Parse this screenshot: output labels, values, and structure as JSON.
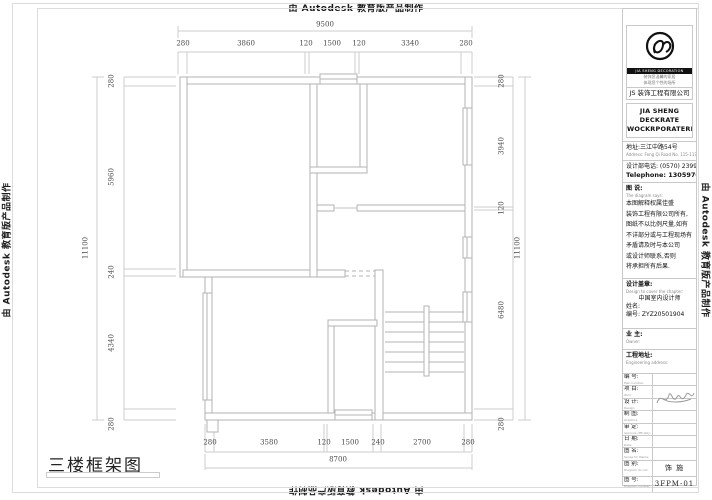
{
  "edge_watermark": "由 Autodesk 教育版产品制作",
  "drawing_title": "三楼框架图",
  "dims": {
    "top": {
      "overall": "9500",
      "segments": [
        "280",
        "3860",
        "120",
        "1500",
        "120",
        "3340",
        "280"
      ]
    },
    "bottom": {
      "overall": "8700",
      "segments": [
        "280",
        "3580",
        "120",
        "1500",
        "240",
        "2700",
        "280"
      ]
    },
    "left": {
      "overall": "11100",
      "segments": [
        "280",
        "5960",
        "240",
        "4340",
        "280"
      ]
    },
    "right": {
      "overall": "11100",
      "segments": [
        "280",
        "3940",
        "120",
        "6480",
        "280"
      ]
    }
  },
  "titleblock": {
    "logo": {
      "brand_en": "JIA SHENG DECORATION",
      "tagline1": "装饰您温馨的家居",
      "tagline2": "体现您个性的场所",
      "company_cn": "JS 装饰工程有限公司",
      "company_en1": "JIA SHENG DECKRATE",
      "company_en2": "WOCKRPORATERKS"
    },
    "address_cn": "地址:三江中路54号",
    "address_en": "Address: Feng Qi Road No. 115-117",
    "phone_cn": "设计部电话: (0570) 2399049",
    "phone_en": "Telephone: 13059700047",
    "notes_title_cn": "图 说:",
    "notes_title_en": "The diagram says:",
    "notes_lines": {
      "0": "本图解释权属佳盛",
      "1": "装饰工程有限公司所有,",
      "2": "图纸不以比例尺量,如有",
      "3": "不详部分或与工程现场有",
      "4": "矛盾请及时与本公司",
      "5": "或设计师联系,否则",
      "6": "将承担所有后果."
    },
    "seal_label_cn": "设计盖章:",
    "seal_label_en": "Design to cover the chapter:",
    "seal_line1": "中国室内设计师",
    "seal_name": "姓名:",
    "seal_no": "编号: ZYZ20501904",
    "owner_cn": "业 主:",
    "owner_en": "Owner:",
    "site_cn": "工程地址:",
    "site_en": "Engineering address:",
    "rows": {
      "0": {
        "cn": "编 号:",
        "en": "Plan number:",
        "value": ""
      },
      "1": {
        "cn": "项 目:",
        "en": "Item:",
        "value": ""
      },
      "2": {
        "cn": "设 计:",
        "en": "Design:",
        "value": ""
      },
      "3": {
        "cn": "制 图:",
        "en": "Graphics:",
        "value": ""
      },
      "4": {
        "cn": "审 定:",
        "en": "Approve officially:",
        "value": ""
      },
      "5": {
        "cn": "日 期:",
        "en": "Date:",
        "value": ""
      },
      "6": {
        "cn": "图 名:",
        "en": "Series for Name:",
        "value": ""
      },
      "7": {
        "cn": "图 别:",
        "en": "Diagram do not:",
        "value": "饰 施"
      },
      "8": {
        "cn": "图 号:",
        "en": "Diagram number:",
        "value": "3FPM-01"
      }
    }
  },
  "colors": {
    "wall_line": "#b3b3b3",
    "dim_line": "#cccccc",
    "frame_line": "#dcdcdc",
    "text": "#333333"
  }
}
